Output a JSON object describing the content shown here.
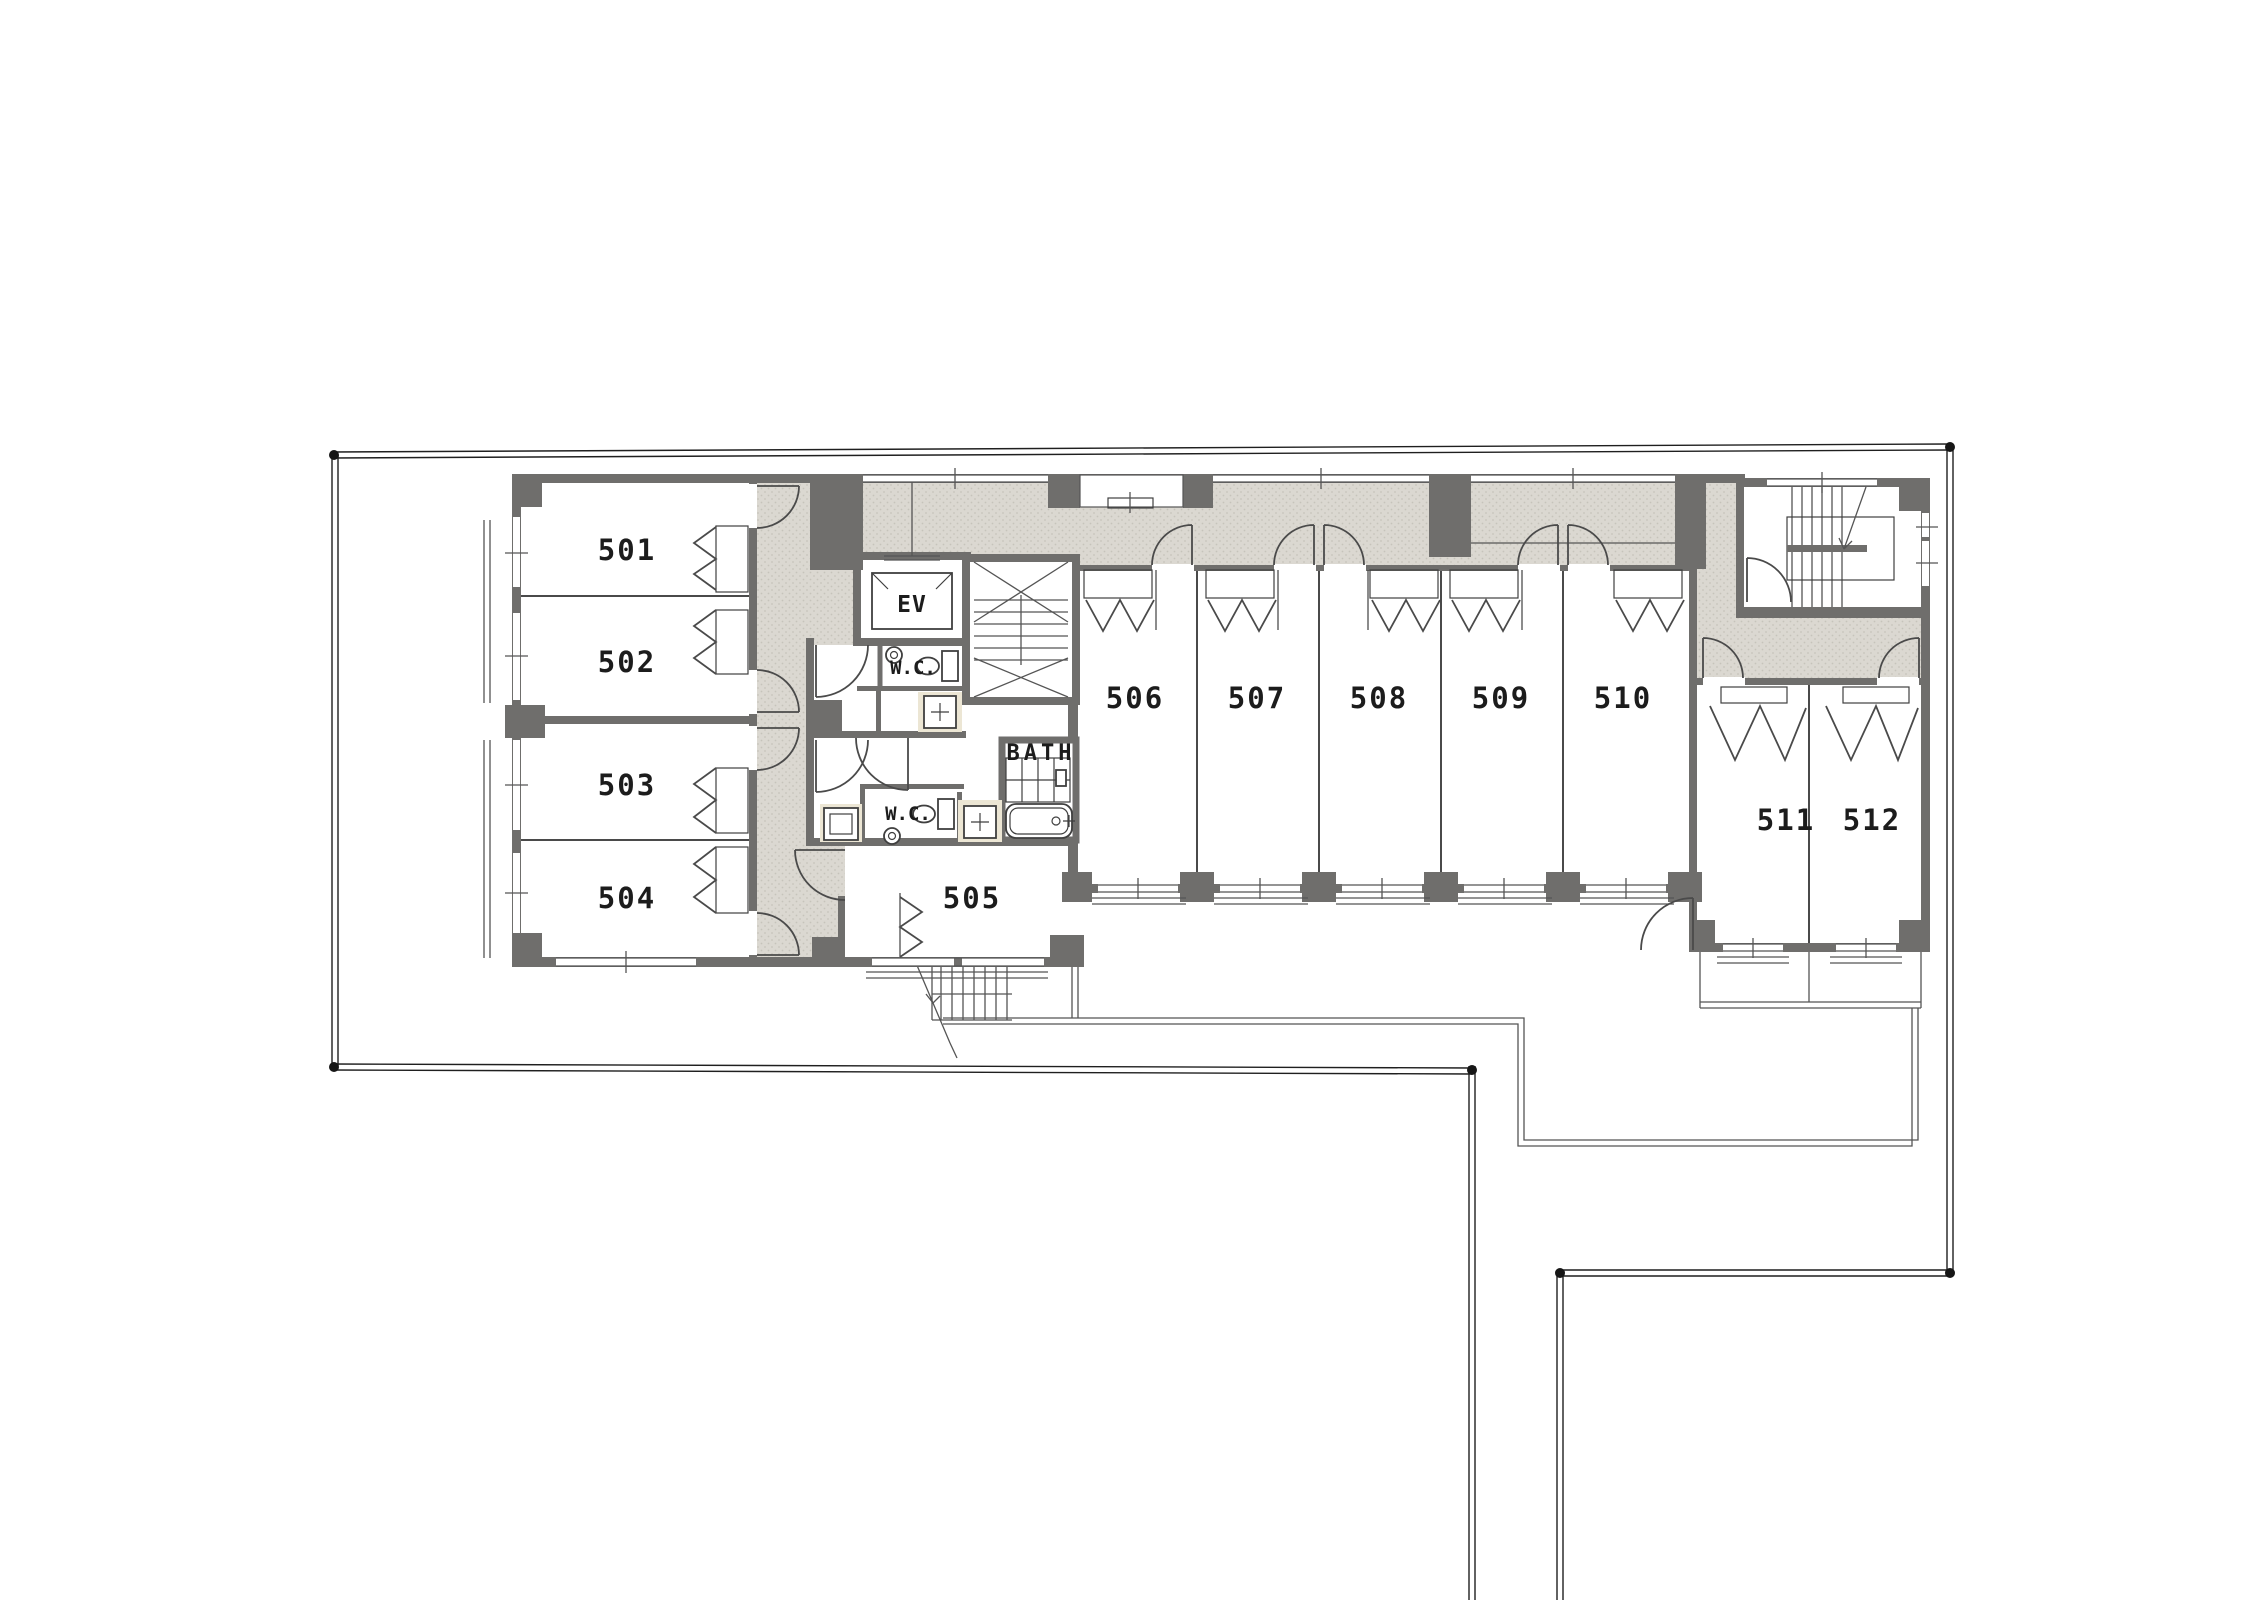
{
  "floor_plan": {
    "rooms": [
      {
        "number": "501"
      },
      {
        "number": "502"
      },
      {
        "number": "503"
      },
      {
        "number": "504"
      },
      {
        "number": "505"
      },
      {
        "number": "506"
      },
      {
        "number": "507"
      },
      {
        "number": "508"
      },
      {
        "number": "509"
      },
      {
        "number": "510"
      },
      {
        "number": "511"
      },
      {
        "number": "512"
      }
    ],
    "core": {
      "elevator_label": "EV",
      "wc_upper_label": "W.C.",
      "wc_lower_label": "W.C.",
      "bath_label": "BATH"
    },
    "colors": {
      "wall": "#6f6e6c",
      "corridor_fill": "#dbd8d1",
      "corridor_dot": "#c6c3bb",
      "fixture_alcove": "#ece6d4",
      "line": "#4a4a4a",
      "boundary": "#1f1f1f",
      "background": "#ffffff"
    }
  }
}
